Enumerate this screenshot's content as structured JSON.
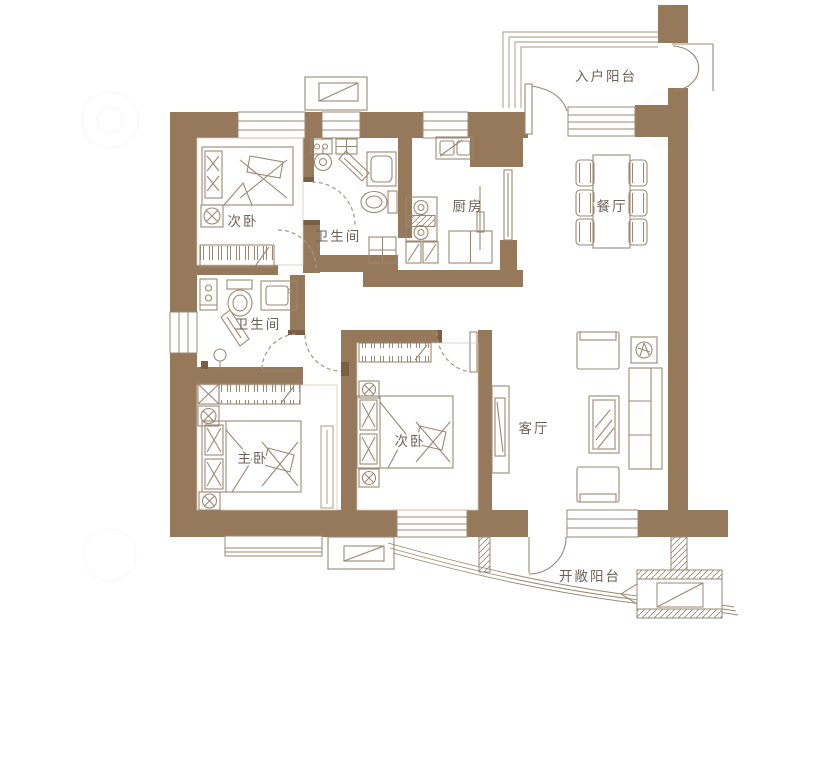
{
  "rooms": [
    {
      "id": "bedroom-top-left",
      "label": "次卧"
    },
    {
      "id": "bathroom-top",
      "label": "卫生间"
    },
    {
      "id": "kitchen",
      "label": "厨房"
    },
    {
      "id": "entry-balcony",
      "label": "入户阳台"
    },
    {
      "id": "dining-room",
      "label": "餐厅"
    },
    {
      "id": "bathroom-middle",
      "label": "卫生间"
    },
    {
      "id": "master-bedroom",
      "label": "主卧"
    },
    {
      "id": "bedroom-middle",
      "label": "次卧"
    },
    {
      "id": "living-room",
      "label": "客厅"
    },
    {
      "id": "open-balcony",
      "label": "开敞阳台"
    }
  ],
  "colors": {
    "wall": "#96785a",
    "wall_cap": "#7b5f44",
    "line": "#9b8873",
    "label": "#6b6257",
    "background": "#ffffff"
  }
}
